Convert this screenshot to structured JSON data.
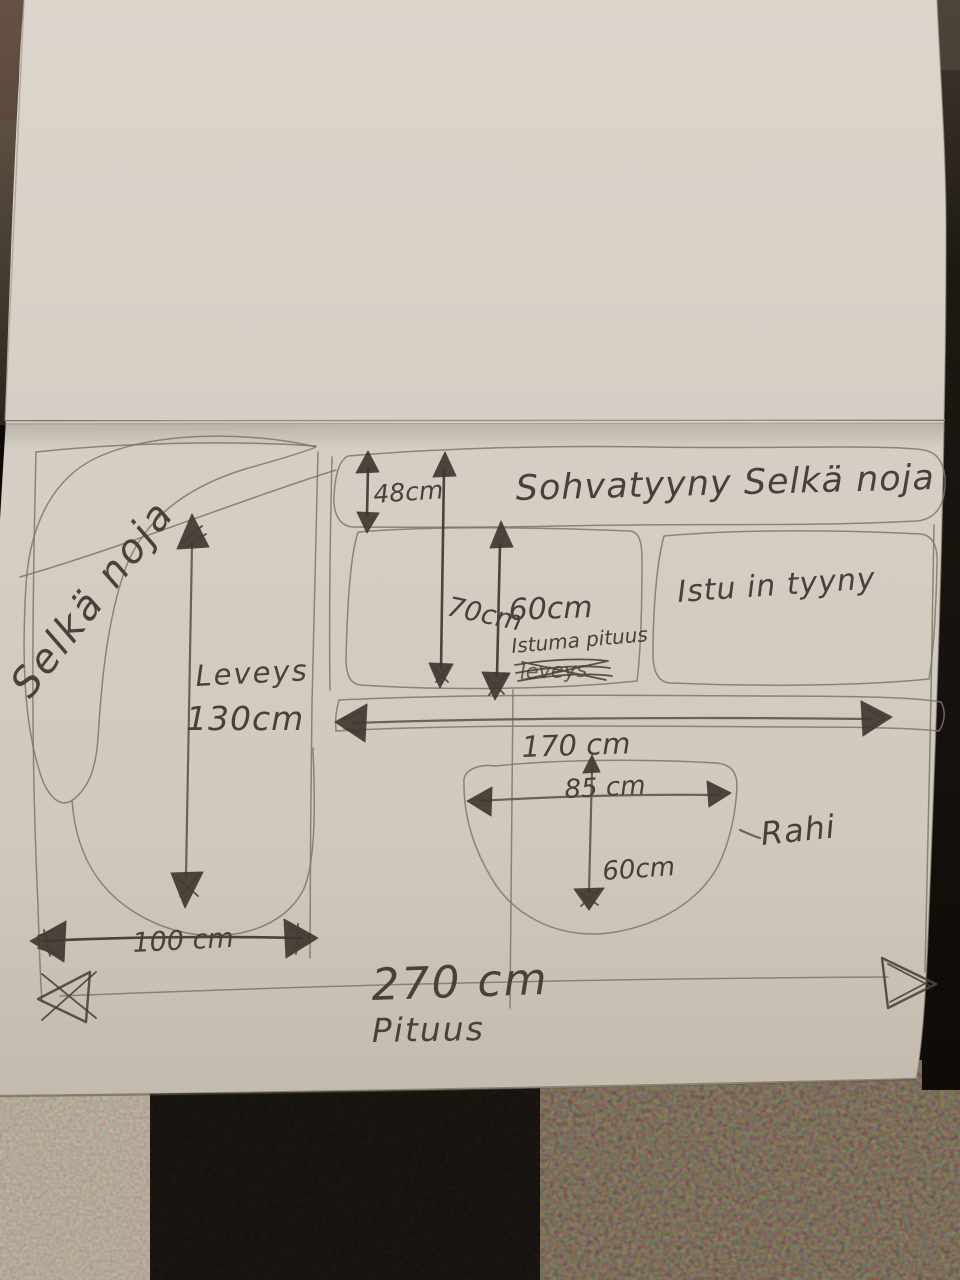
{
  "scene": {
    "description": "Photograph of a hand-drawn sofa measurement sketch in pencil on a folded notebook page, lying on dark carpet",
    "language": "Finnish"
  },
  "sketch": {
    "title_band": "Sohvatyyny Selkä noja",
    "seat_cushion_label": "Istu in tyyny",
    "left_backrest_label": "Selkä noja",
    "width_label": "Leveys",
    "length_label": "Pituus",
    "ottoman_label": "Rahi",
    "ottoman_dash": "–",
    "seating_depth_label": "Istuma pituus",
    "crossed_out_word": "leveys",
    "dimensions": {
      "backrest_thickness": "48cm",
      "chaise_depth": "70cm",
      "seating_depth": "60cm",
      "sofa_width": "130cm",
      "chaise_width": "100 cm",
      "seat_front_width": "170 cm",
      "ottoman_width": "85 cm",
      "ottoman_depth": "60cm",
      "sofa_length": "270 cm"
    }
  },
  "colors": {
    "paper_top": "#d9d3ca",
    "paper_bottom": "#cfc8bc",
    "pencil": "#46413a",
    "marker_dark": "#3c362e",
    "carpet_black": "#0b0806",
    "carpet_brown": "#271d12",
    "carpet_gray": "#6a5e4f"
  }
}
